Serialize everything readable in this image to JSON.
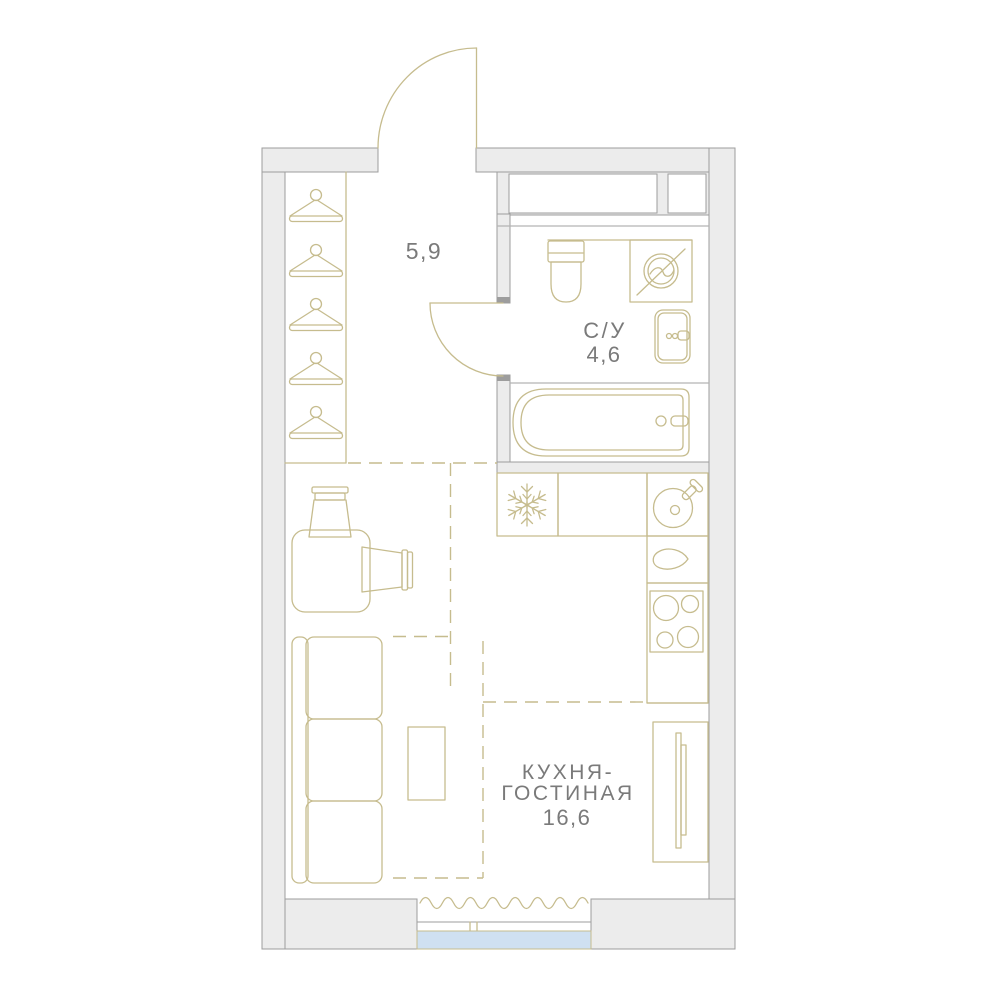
{
  "title": "Studio apartment floor plan",
  "theme": {
    "bg": "#ffffff",
    "wall-fill": "#ececec",
    "wall-stroke": "#9d9d9d",
    "furniture-line": "#c6bc8e",
    "thin-gray": "#b3b3b3",
    "label-color": "#7a7a7a",
    "glass": "#cfe0f1",
    "jamb": "#9d9d9d"
  },
  "rooms": {
    "hallway": {
      "area": "5,9"
    },
    "bathroom": {
      "name": "С/У",
      "area": "4,6"
    },
    "kitchen_living": {
      "name_line1": "КУХНЯ-",
      "name_line2": "ГОСТИНАЯ",
      "area": "16,6"
    }
  }
}
